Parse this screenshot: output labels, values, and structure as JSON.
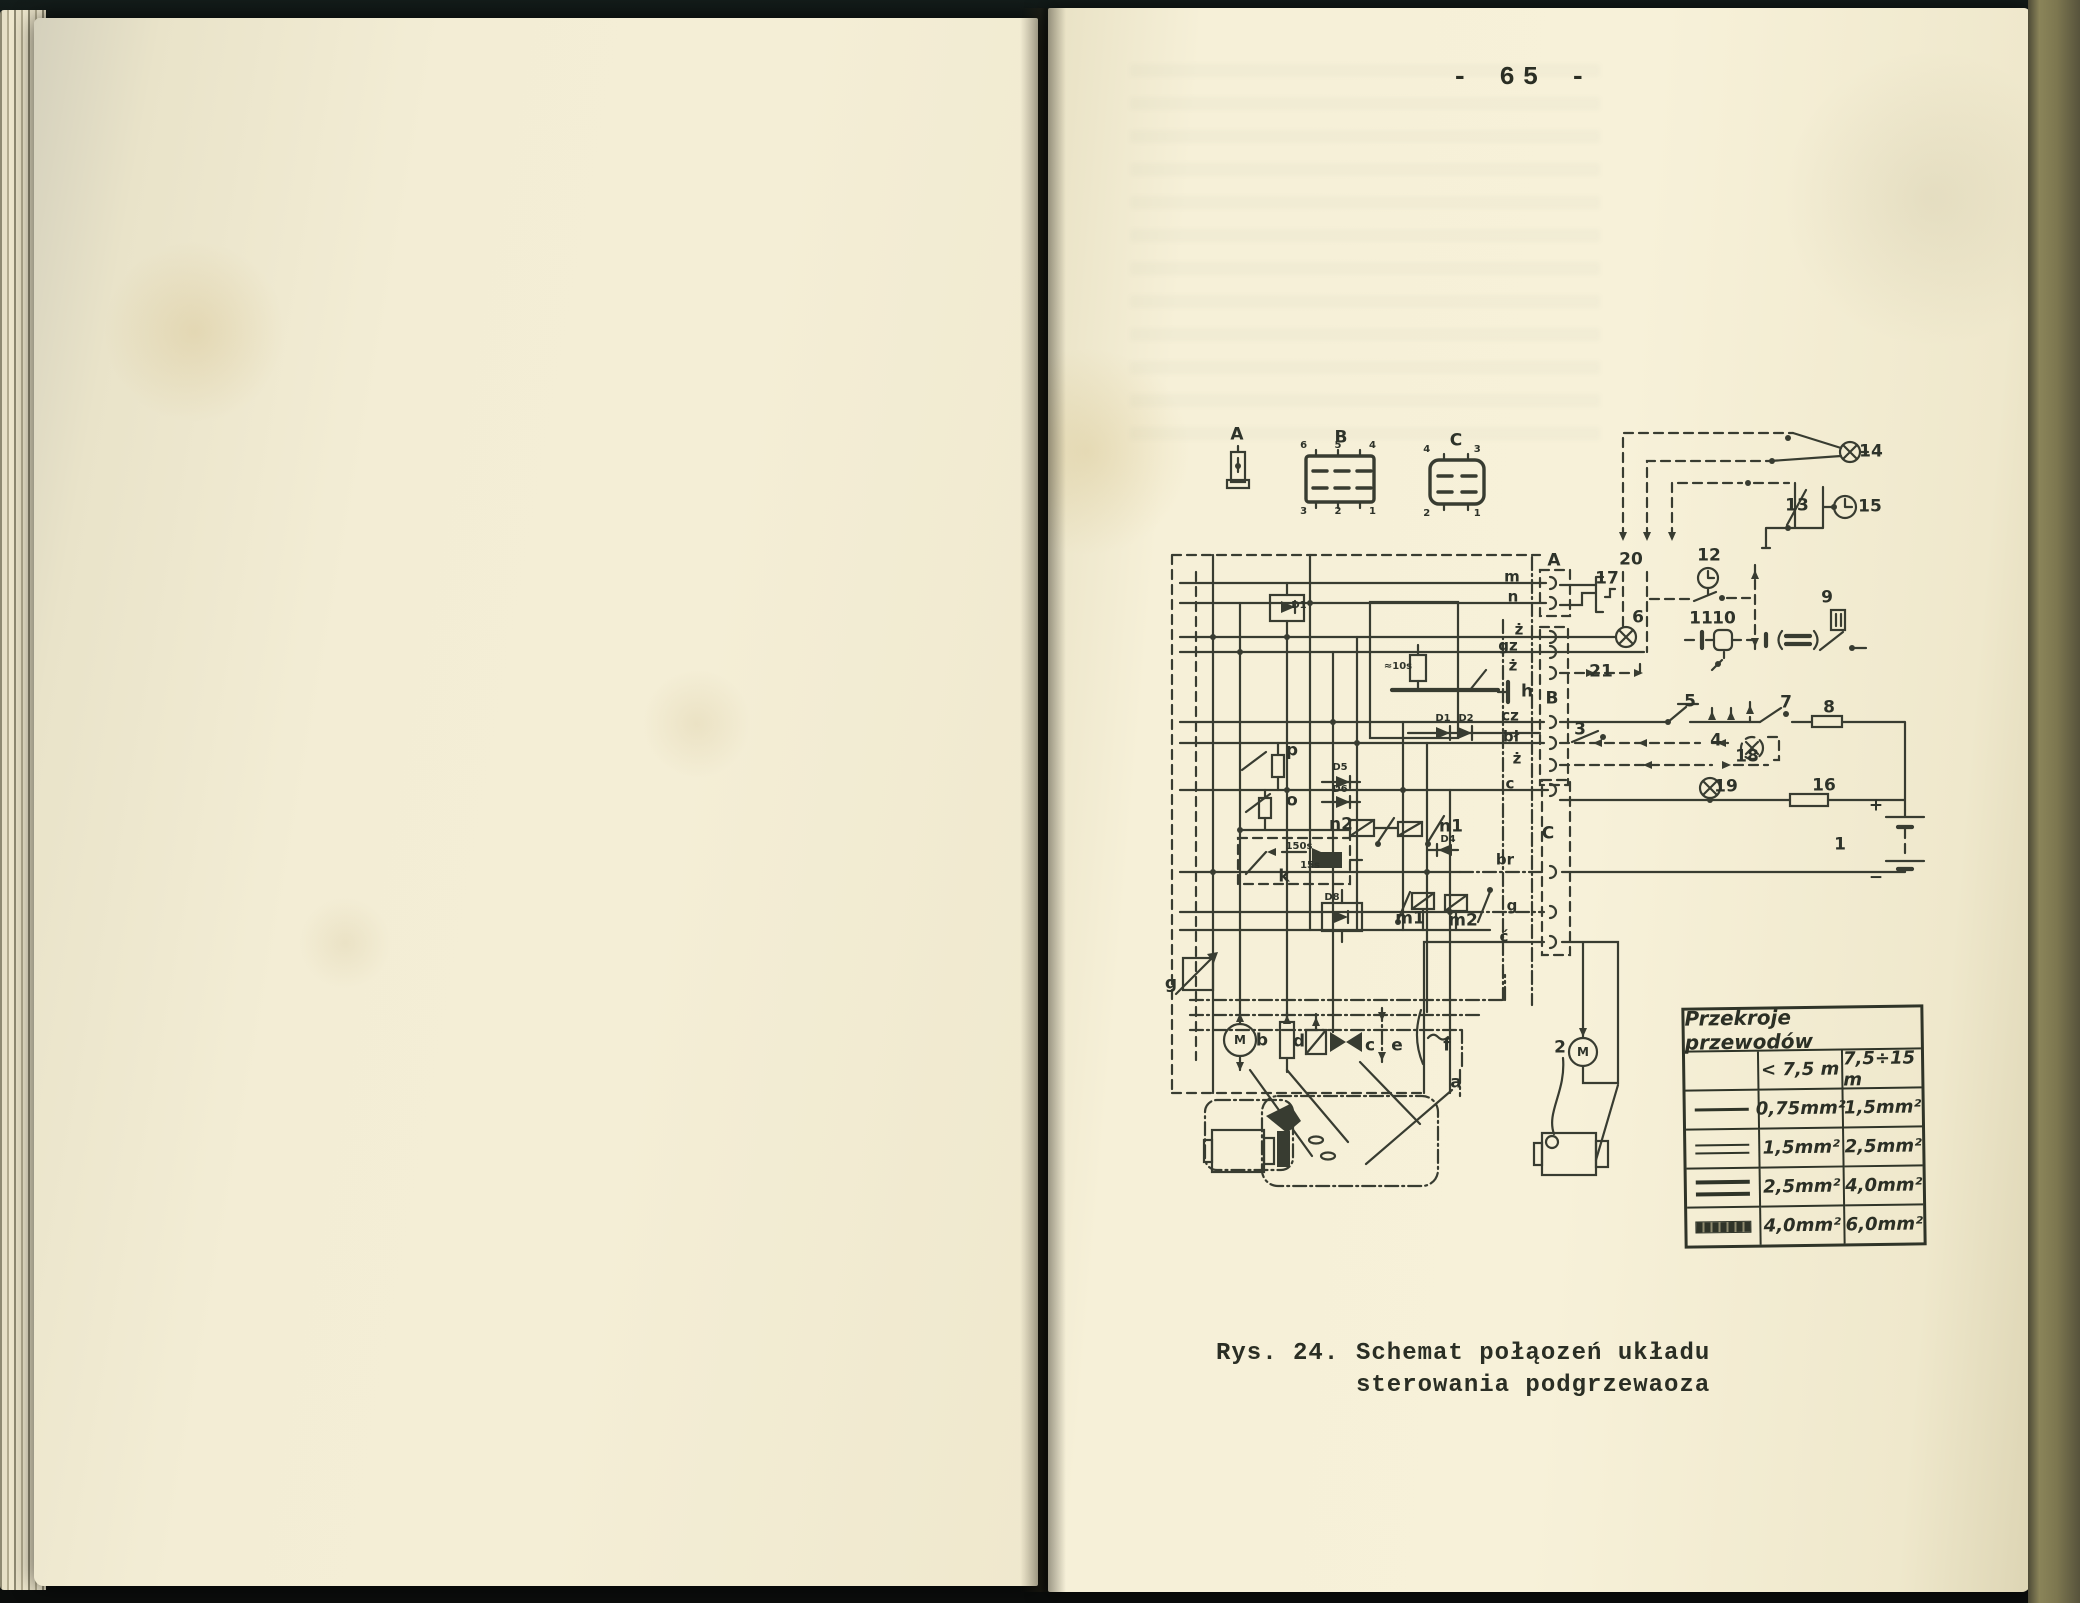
{
  "page": {
    "number": "- 65 -"
  },
  "caption": {
    "prefix": "Rys. 24.",
    "line1": "Schemat połąozeń układu",
    "line2": "sterowania podgrzewaoza"
  },
  "legend": {
    "a": "A",
    "b": "B",
    "c": "C",
    "b_pins_top": "6 5 4",
    "b_pins_bottom": "3 2 1",
    "c_pins_top": "4 3",
    "c_pins_bottom": "2 1"
  },
  "diagram": {
    "numbers": {
      "1": "1",
      "2": "2",
      "3": "3",
      "4": "4",
      "5": "5",
      "6": "6",
      "7": "7",
      "8": "8",
      "9": "9",
      "10": "10",
      "11": "11",
      "12": "12",
      "13": "13",
      "14": "14",
      "15": "15",
      "16": "16",
      "17": "17",
      "18": "18",
      "19": "19",
      "20": "20",
      "21": "21"
    },
    "letters": {
      "strip_a": "A",
      "strip_b": "B",
      "strip_c": "C",
      "h": "h",
      "p": "p",
      "o": "o",
      "k": "k",
      "n1": "n1",
      "n2": "n2",
      "m1": "m1",
      "m2": "m2",
      "g": "g",
      "a": "a",
      "b": "b",
      "c": "c",
      "d": "d",
      "e": "e",
      "f": "f",
      "motor": "M"
    },
    "diodes": {
      "d1_box": "D1",
      "d1_row": "D1",
      "d2_row": "D2",
      "d4": "D4",
      "d5": "D5",
      "d6": "D6",
      "d8": "D8"
    },
    "timings": {
      "t150": "150s",
      "t15": "15s",
      "t10": "≈10s"
    },
    "wires": {
      "w1": "m",
      "w2": "n",
      "w3": "ż",
      "w4": "gz",
      "w5": "ż",
      "w6": "cz",
      "w7": "bł",
      "w8": "ż",
      "w9": "c",
      "w10": "br",
      "w11": "g",
      "w12": "ć"
    },
    "battery": {
      "plus": "+",
      "minus": "−"
    }
  },
  "wire_table": {
    "title": "Przekroje przewodów",
    "col1_header": "< 7,5 m",
    "col2_header": "7,5÷15 m",
    "rows": [
      {
        "symbol": "single-line",
        "col1": "0,75mm²",
        "col2": "1,5mm²"
      },
      {
        "symbol": "double-line",
        "col1": "1,5mm²",
        "col2": "2,5mm²"
      },
      {
        "symbol": "double-line-bold",
        "col1": "2,5mm²",
        "col2": "4,0mm²"
      },
      {
        "symbol": "thick-hatched-bar",
        "col1": "4,0mm²",
        "col2": "6,0mm²"
      }
    ]
  }
}
